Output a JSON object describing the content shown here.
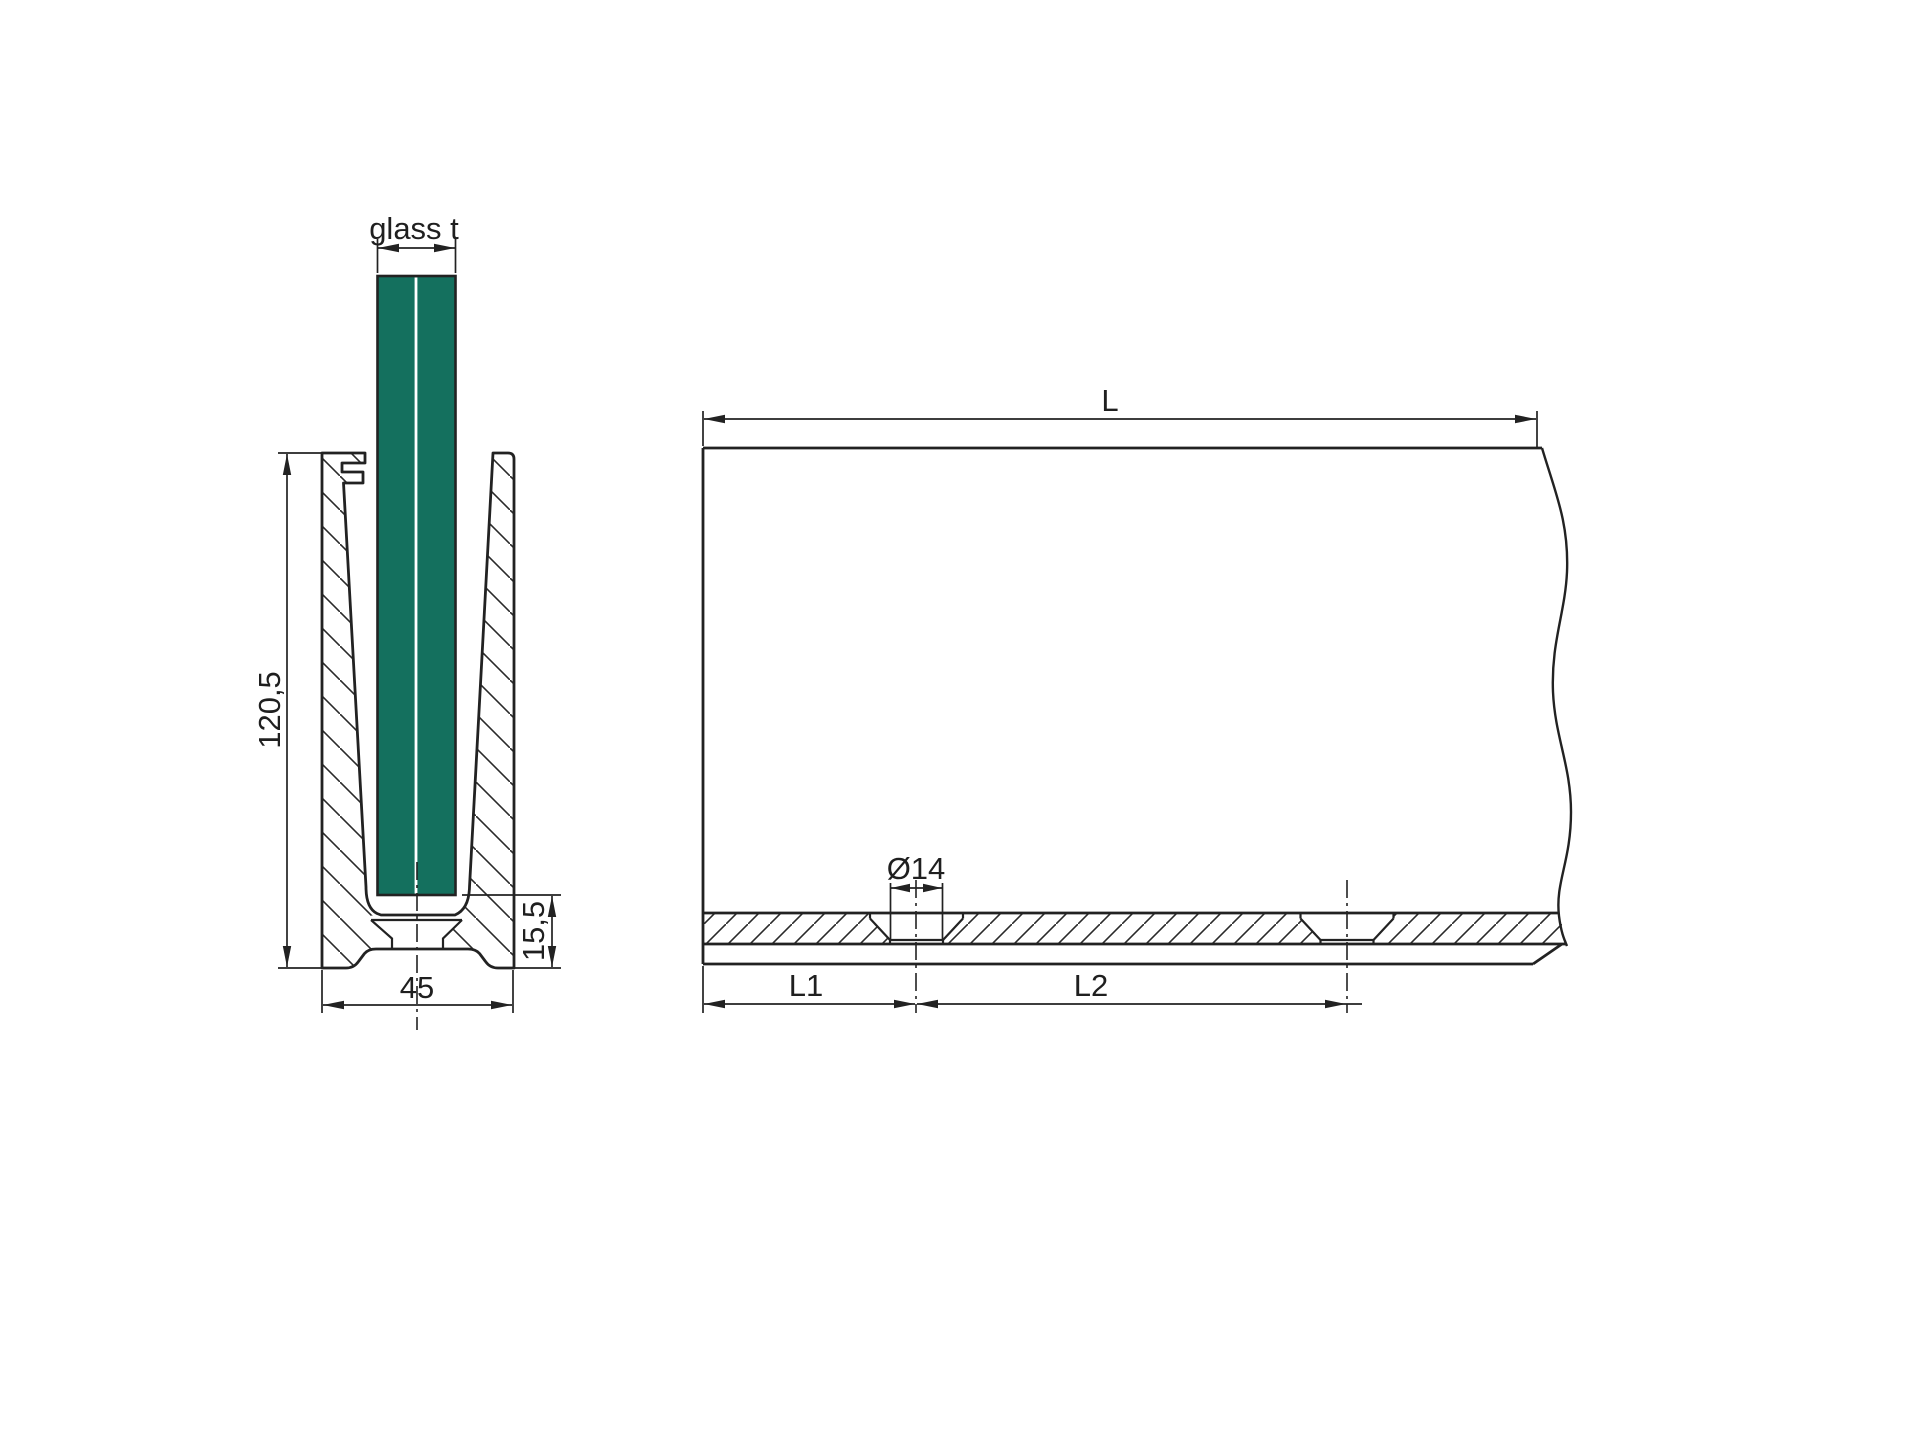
{
  "title": "Glass channel profile technical drawing",
  "section_view": {
    "glass_thickness_label": "glass t",
    "profile_height": "120,5",
    "base_width": "45",
    "base_height": "15,5"
  },
  "side_view": {
    "length_label": "L",
    "hole_diameter": "Ø14",
    "end_to_first_hole": "L1",
    "hole_spacing": "L2"
  },
  "colors": {
    "glass": "#14705E",
    "line": "#222222",
    "background": "#FFFFFF"
  }
}
